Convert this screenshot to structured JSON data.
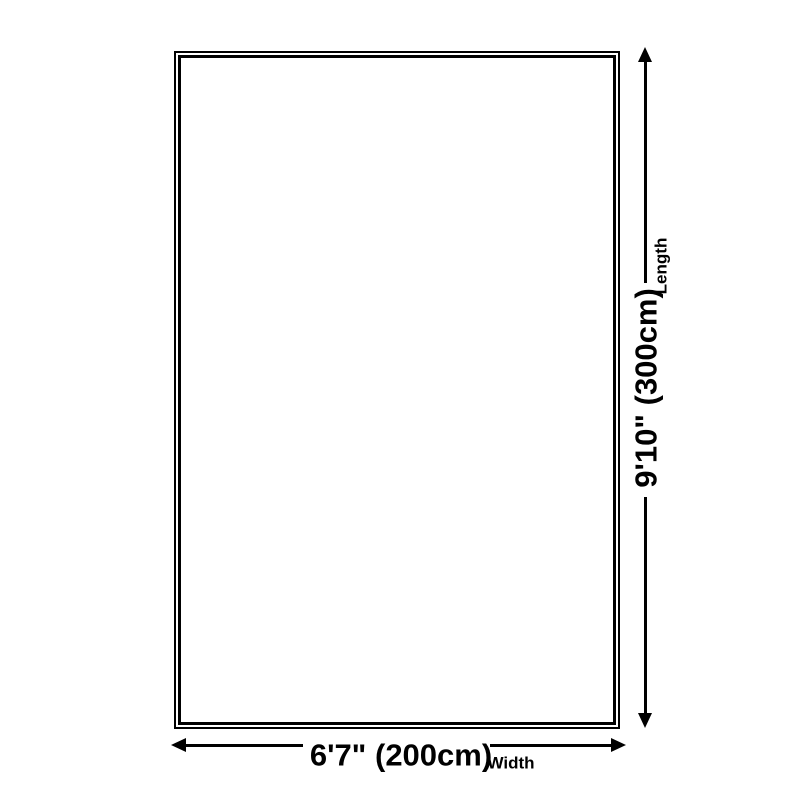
{
  "diagram": {
    "length": {
      "value": "9'10\" (300cm)",
      "caption": "Length"
    },
    "width": {
      "value": "6'7\" (200cm)",
      "caption": "Width"
    },
    "colors": {
      "line": "#000000",
      "background": "#ffffff"
    }
  }
}
